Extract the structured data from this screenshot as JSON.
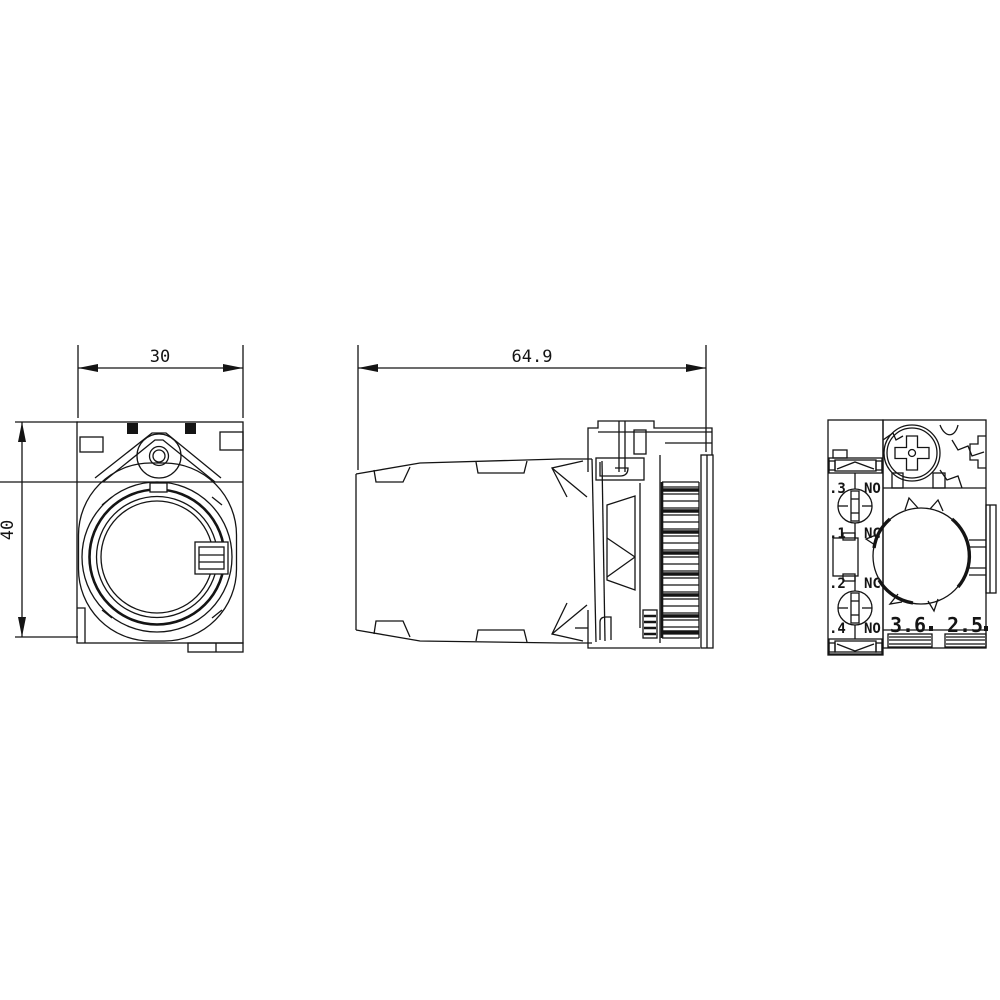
{
  "sheet": {
    "background": "#ffffff",
    "line_color": "#141414",
    "content": "technical dimension drawing of pushbutton actuator with holder and contact module, three orthographic views"
  },
  "views": {
    "front": {
      "label": "front-view",
      "dims": {
        "width": "30",
        "height": "40"
      }
    },
    "side": {
      "label": "side-view",
      "dims": {
        "length": "64.9"
      }
    },
    "rear": {
      "label": "rear-view",
      "terminals": [
        {
          "id": ".3",
          "type": "NO"
        },
        {
          "id": ".1",
          "type": "NC"
        },
        {
          "id": ".2",
          "type": "NC"
        },
        {
          "id": ".4",
          "type": "NO"
        }
      ],
      "dims": {
        "left": "3.6",
        "right": "2.5"
      }
    }
  }
}
